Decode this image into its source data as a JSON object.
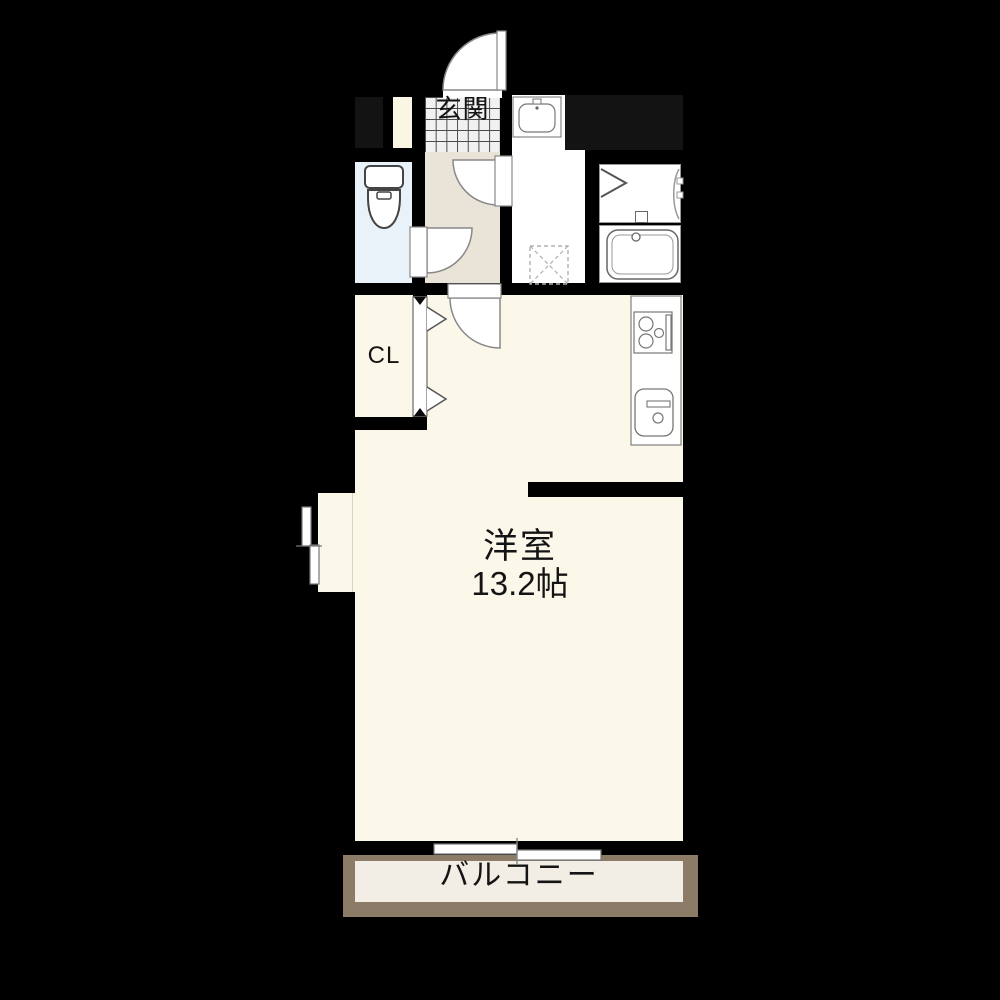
{
  "plan_title": "apartment-floor-plan",
  "labels": {
    "genkan": "玄関",
    "closet": "CL",
    "living_room": "洋室",
    "living_size": "13.2帖",
    "balcony": "バルコニー"
  },
  "colors": {
    "background": "#000000",
    "wall": "#000000",
    "room_floor": "#FCF8E9",
    "hallway_floor": "#E9E3D8",
    "toilet_floor": "#EAF2F9",
    "wet_area_floor": "#FFFFFF",
    "balcony_floor": "#F2EEE6",
    "balcony_wall": "#8C7B67",
    "void_space": "#131313",
    "nook_floor": "#FBF5E3",
    "fixture_outline": "#777777"
  },
  "fixtures": {
    "entrance-door-icon": "quarter-swing-door",
    "hallway-door-icon": "quarter-swing-door",
    "toilet-door-icon": "quarter-swing-door",
    "room-door-icon": "quarter-swing-door",
    "closet-folding-door-icon": "chevron-folding-door",
    "bath-folding-door-icon": "chevron-folding-door",
    "toilet-icon": "toilet-with-tank",
    "vanity-sink-icon": "washbasin",
    "washer-pan-icon": "dashed-square-cross",
    "bathtub-icon": "bathtub",
    "stove-icon": "three-burner-stove",
    "kitchen-sink-icon": "kitchen-sink",
    "window-left-icon": "double-sliding-window",
    "window-balcony-icon": "double-sliding-door"
  }
}
